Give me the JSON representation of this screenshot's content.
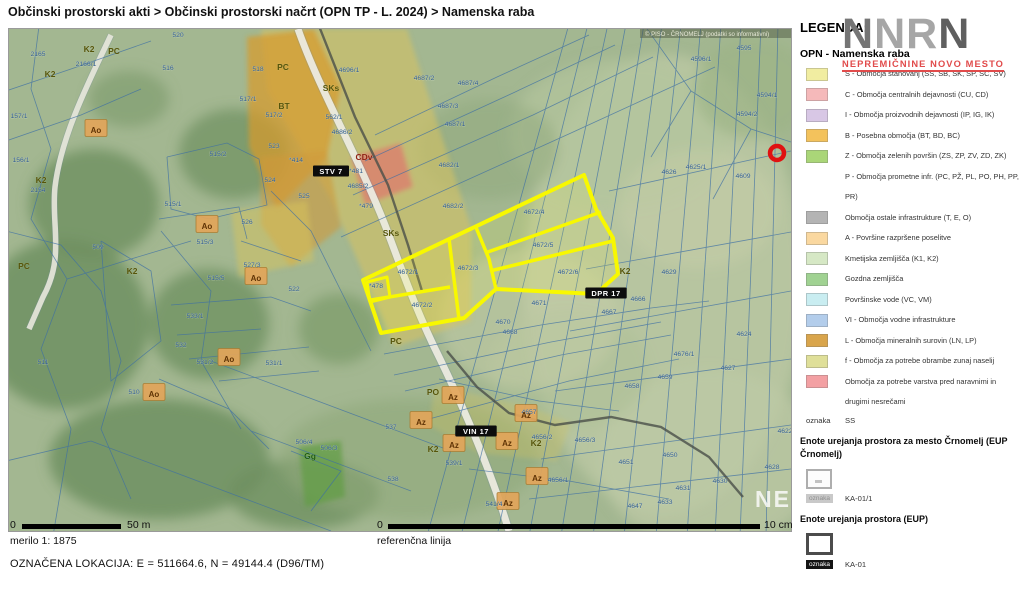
{
  "breadcrumb": "Občinski prostorski akti > Občinski prostorski načrt (OPN TP - L. 2024) > Namenska raba",
  "legend": {
    "title": "LEGENDA:",
    "logo_big": "NNRN",
    "logo_sub": "NEPREMIČNINE NOVO MESTO",
    "section1_title": "OPN - Namenska raba",
    "items": [
      {
        "color": "#f1eda1",
        "label": "S - Območja stanovanj (SS, SB, SK, SP, SC, SV)"
      },
      {
        "color": "#f5b9ba",
        "label": "C - Območja centralnih dejavnosti (CU, CD)"
      },
      {
        "color": "#d8c7e5",
        "label": "I - Območja proizvodnih dejavnosti (IP, IG, IK)"
      },
      {
        "color": "#f3c25c",
        "label": "B - Posebna območja (BT, BD, BC)"
      },
      {
        "color": "#aad678",
        "label": "Z - Območja zelenih površin (ZS, ZP, ZV, ZD, ZK)"
      },
      {
        "color": null,
        "label": "P - Območja prometne infr. (PC, PŽ, PL, PO, PH, PP, PR)"
      },
      {
        "color": "#b4b4b4",
        "label": "Območja ostale infrastrukture (T, E, O)"
      },
      {
        "color": "#fad8a0",
        "label": "A - Površine razpršene poselitve"
      },
      {
        "color": "#d6e8c5",
        "label": "Kmetijska zemljišča (K1, K2)"
      },
      {
        "color": "#a0d292",
        "label": "Gozdna zemljišča"
      },
      {
        "color": "#c9edf1",
        "label": "Površinske vode (VC, VM)"
      },
      {
        "color": "#b3cdeb",
        "label": "VI - Območja vodne infrastrukture"
      },
      {
        "color": "#d9a54c",
        "label": "L - Območja mineralnih surovin (LN, LP)"
      },
      {
        "color": "#dfdf99",
        "label": "f - Območja za potrebe obrambe zunaj naselij"
      },
      {
        "color": "#f3a0a3",
        "label": "Območja za potrebe varstva pred naravnimi in drugimi nesrečami"
      }
    ],
    "oznaka_ss": {
      "label": "oznaka",
      "value": "SS"
    },
    "eup_crnomelj": {
      "title": "Enote urejanja prostora za mesto Črnomelj (EUP Črnomelj)",
      "oznaka": "oznaka",
      "value": "KA-01/1"
    },
    "eup": {
      "title": "Enote urejanja prostora (EUP)",
      "oznaka": "oznaka",
      "value": "KA-01"
    }
  },
  "scalebar": {
    "zero": "0",
    "label": "50 m",
    "merilo": "merilo 1: 1875"
  },
  "refline": {
    "zero": "0",
    "label": "10 cm",
    "caption": "referenčna linija"
  },
  "location_line": "OZNAČENA LOKACIJA:  E = 511664.6,  N = 49144.4 (D96/TM)",
  "map": {
    "watermark_top": "© PISO - ČRNOMELJ (podatki so informativni)",
    "watermark_brand": "NEP",
    "marker": {
      "x": 768,
      "y": 124,
      "color": "#e01111"
    },
    "selection_color": "#f8f800",
    "eup_boxes": [
      {
        "t": "STV 7",
        "x": 322,
        "y": 145
      },
      {
        "t": "VIN 17",
        "x": 467,
        "y": 405
      },
      {
        "t": "DPR 17",
        "x": 597,
        "y": 267
      }
    ],
    "zone_labels": [
      {
        "t": "K2",
        "x": 80,
        "y": 23,
        "c": "olive"
      },
      {
        "t": "PC",
        "x": 105,
        "y": 25,
        "c": "olive"
      },
      {
        "t": "K2",
        "x": 41,
        "y": 48,
        "c": "olive"
      },
      {
        "t": "K2",
        "x": 32,
        "y": 154,
        "c": "olive"
      },
      {
        "t": "PC",
        "x": 274,
        "y": 41,
        "c": "olive"
      },
      {
        "t": "BT",
        "x": 275,
        "y": 80,
        "c": "olive"
      },
      {
        "t": "SKs",
        "x": 322,
        "y": 62,
        "c": "olive"
      },
      {
        "t": "SKs",
        "x": 382,
        "y": 207,
        "c": "olive"
      },
      {
        "t": "CDv",
        "x": 355,
        "y": 131,
        "c": "red"
      },
      {
        "t": "K2",
        "x": 616,
        "y": 245,
        "c": "olive"
      },
      {
        "t": "K2",
        "x": 123,
        "y": 245,
        "c": "olive"
      },
      {
        "t": "PC",
        "x": 15,
        "y": 240,
        "c": "olive"
      },
      {
        "t": "PC",
        "x": 387,
        "y": 315,
        "c": "olive"
      },
      {
        "t": "PO",
        "x": 424,
        "y": 366,
        "c": "olive"
      },
      {
        "t": "K2",
        "x": 424,
        "y": 423,
        "c": "olive"
      },
      {
        "t": "K2",
        "x": 527,
        "y": 417,
        "c": "olive"
      },
      {
        "t": "Gg",
        "x": 301,
        "y": 430,
        "c": "green"
      },
      {
        "t": "Az",
        "x": 412,
        "y": 396,
        "c": "az"
      },
      {
        "t": "Az",
        "x": 445,
        "y": 419,
        "c": "az"
      },
      {
        "t": "Az",
        "x": 444,
        "y": 371,
        "c": "az"
      },
      {
        "t": "Az",
        "x": 498,
        "y": 417,
        "c": "az"
      },
      {
        "t": "Az",
        "x": 528,
        "y": 452,
        "c": "az"
      },
      {
        "t": "Az",
        "x": 499,
        "y": 477,
        "c": "az"
      },
      {
        "t": "Az",
        "x": 517,
        "y": 389,
        "c": "az"
      },
      {
        "t": "Ao",
        "x": 198,
        "y": 200,
        "c": "az"
      },
      {
        "t": "Ao",
        "x": 247,
        "y": 252,
        "c": "az"
      },
      {
        "t": "Ao",
        "x": 220,
        "y": 333,
        "c": "az"
      },
      {
        "t": "Ao",
        "x": 145,
        "y": 368,
        "c": "az"
      },
      {
        "t": "Ao",
        "x": 87,
        "y": 104,
        "c": "az"
      }
    ],
    "parcel_labels": [
      [
        "520",
        169,
        8
      ],
      [
        "516",
        159,
        41
      ],
      [
        "518",
        249,
        42
      ],
      [
        "2165",
        29,
        27
      ],
      [
        "2166/1",
        77,
        37
      ],
      [
        "2154",
        29,
        163
      ],
      [
        "157/1",
        10,
        89
      ],
      [
        "156/1",
        12,
        133
      ],
      [
        "517/1",
        239,
        72
      ],
      [
        "517/2",
        265,
        88
      ],
      [
        "515/2",
        209,
        127
      ],
      [
        "515/1",
        164,
        177
      ],
      [
        "523",
        265,
        119
      ],
      [
        "524",
        261,
        153
      ],
      [
        "525",
        295,
        169
      ],
      [
        "526",
        238,
        195
      ],
      [
        "*414",
        287,
        133
      ],
      [
        "*481",
        347,
        144
      ],
      [
        "*479",
        357,
        179
      ],
      [
        "562/1",
        325,
        90
      ],
      [
        "4696/1",
        340,
        43
      ],
      [
        "4686/2",
        333,
        105
      ],
      [
        "4685/2",
        349,
        159
      ],
      [
        "4682/1",
        440,
        138
      ],
      [
        "4682/2",
        444,
        179
      ],
      [
        "4687/2",
        415,
        51
      ],
      [
        "4687/4",
        459,
        56
      ],
      [
        "4687/3",
        439,
        79
      ],
      [
        "4687/1",
        446,
        97
      ],
      [
        "4672/4",
        525,
        185
      ],
      [
        "4672/5",
        534,
        218
      ],
      [
        "4672/6",
        559,
        245
      ],
      [
        "4672/1",
        399,
        245
      ],
      [
        "4672/3",
        459,
        241
      ],
      [
        "4672/2",
        413,
        278
      ],
      [
        "*478",
        367,
        259
      ],
      [
        "4671",
        530,
        276
      ],
      [
        "4670",
        494,
        295
      ],
      [
        "4668",
        501,
        305
      ],
      [
        "4667",
        600,
        285
      ],
      [
        "4666",
        629,
        272
      ],
      [
        "509",
        89,
        220
      ],
      [
        "515/3",
        196,
        215
      ],
      [
        "515/5",
        207,
        251
      ],
      [
        "527/3",
        243,
        238
      ],
      [
        "533/1",
        186,
        289
      ],
      [
        "532",
        172,
        318
      ],
      [
        "531/2",
        196,
        335
      ],
      [
        "531/1",
        265,
        336
      ],
      [
        "511",
        34,
        335
      ],
      [
        "510",
        125,
        365
      ],
      [
        "522",
        285,
        262
      ],
      [
        "506/4",
        295,
        415
      ],
      [
        "506/3",
        320,
        421
      ],
      [
        "537",
        382,
        400
      ],
      [
        "538",
        384,
        452
      ],
      [
        "539/1",
        445,
        436
      ],
      [
        "541/4",
        485,
        477
      ],
      [
        "4657",
        520,
        385
      ],
      [
        "4656/2",
        533,
        410
      ],
      [
        "4656/3",
        576,
        413
      ],
      [
        "4656/1",
        549,
        453
      ],
      [
        "4595",
        735,
        21
      ],
      [
        "4596/1",
        692,
        32
      ],
      [
        "4594/1",
        758,
        68
      ],
      [
        "4594/2",
        738,
        87
      ],
      [
        "4626",
        660,
        145
      ],
      [
        "4625/1",
        687,
        140
      ],
      [
        "4609",
        734,
        149
      ],
      [
        "4629",
        660,
        245
      ],
      [
        "4624",
        735,
        307
      ],
      [
        "4676/1",
        675,
        327
      ],
      [
        "4627",
        719,
        341
      ],
      [
        "4659",
        656,
        350
      ],
      [
        "4658",
        623,
        359
      ],
      [
        "4651",
        617,
        435
      ],
      [
        "4650",
        661,
        428
      ],
      [
        "4631",
        674,
        461
      ],
      [
        "4630",
        711,
        454
      ],
      [
        "4633",
        656,
        475
      ],
      [
        "4647",
        626,
        479
      ],
      [
        "4628",
        763,
        440
      ],
      [
        "4622",
        776,
        404
      ]
    ]
  }
}
